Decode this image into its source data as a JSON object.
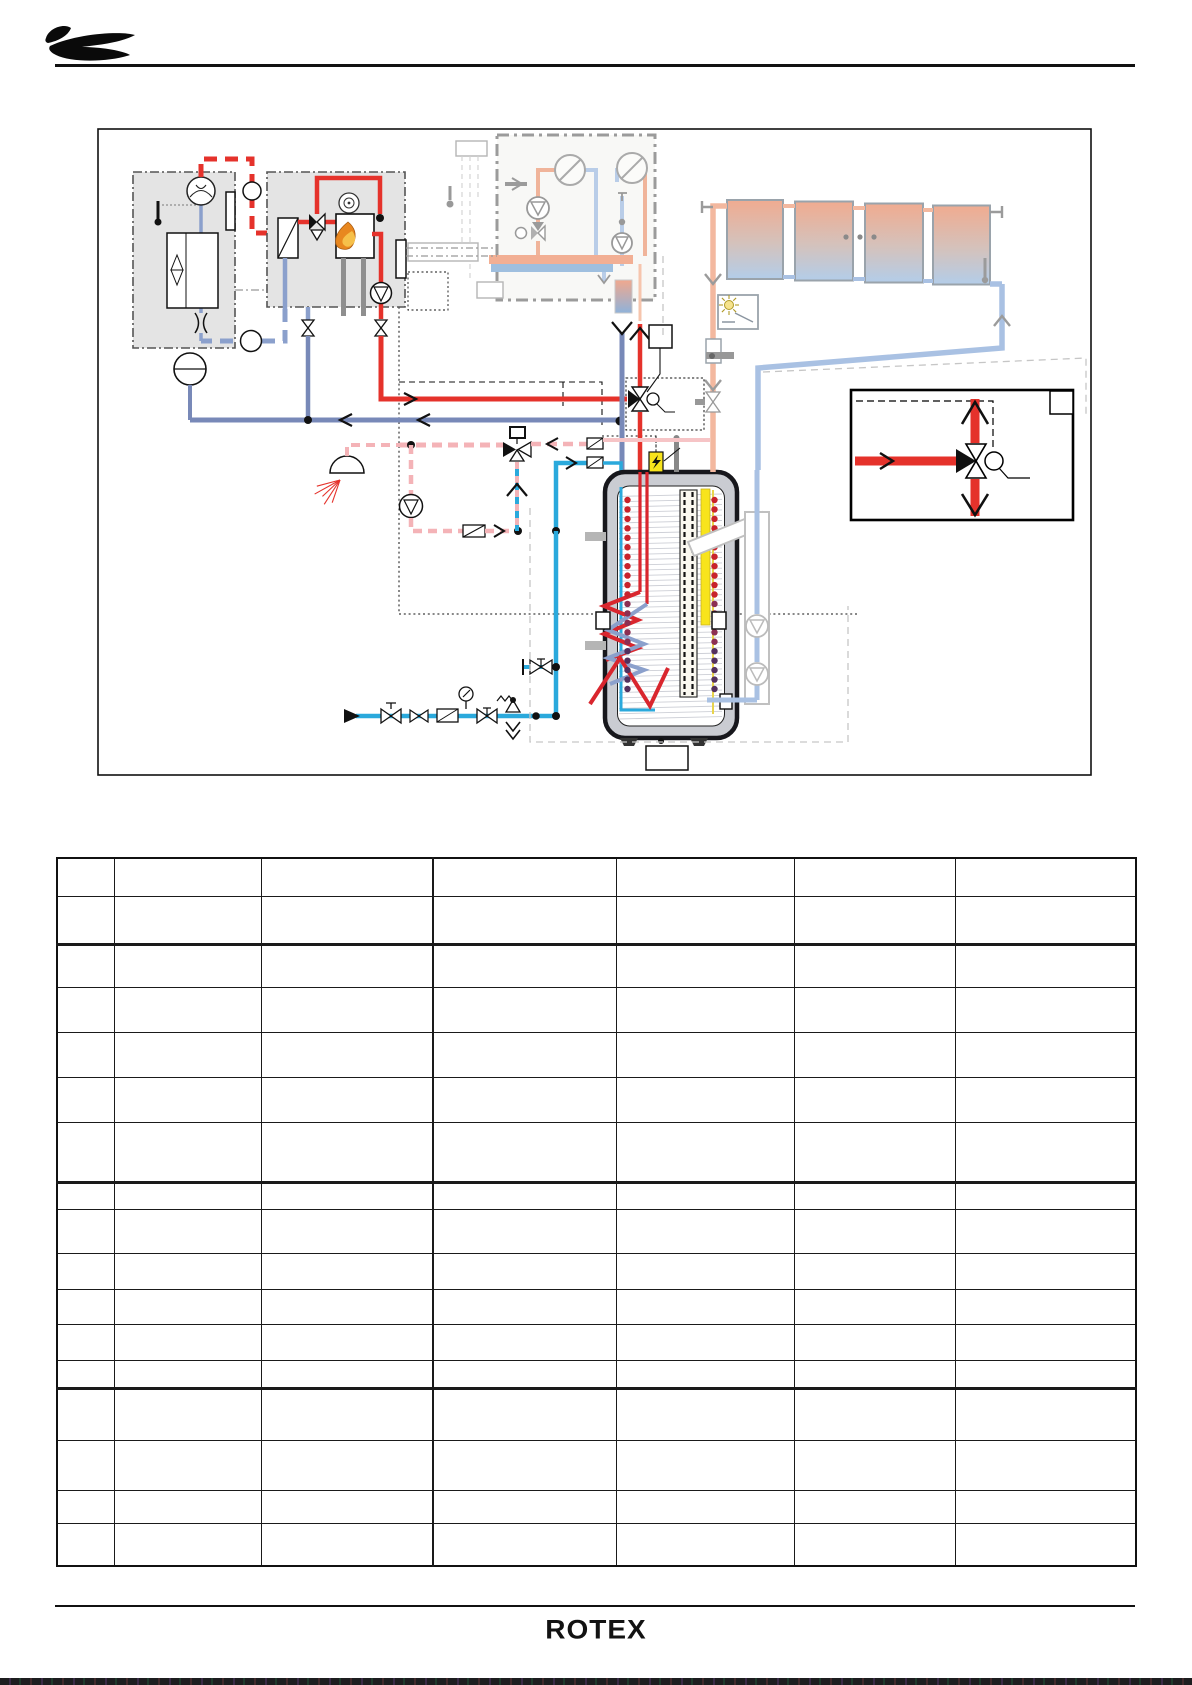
{
  "page": {
    "width": 1192,
    "height": 1685,
    "background": "#ffffff",
    "footer_logo_text": "ROTEX",
    "bottom_bar_color": "#1d1d1f"
  },
  "header": {
    "brand_mark": "manufacturer-swoosh-logo",
    "rule_color": "#111111"
  },
  "diagram": {
    "frame": {
      "x": 98,
      "y": 129,
      "w": 993,
      "h": 646,
      "stroke": "#111111"
    },
    "note": "hydraulic scheme: air-to-water heat pump + boiler + solar collector field charging a Sanicube storage tank; no visible text labels, all label boxes are empty",
    "components": [
      {
        "name": "heat-pump-outdoor-unit"
      },
      {
        "name": "refrigerant-lines"
      },
      {
        "name": "boiler-unit-with-burner"
      },
      {
        "name": "plate-heat-exchanger"
      },
      {
        "name": "heating-circuit-module-faded"
      },
      {
        "name": "expansion-vessel"
      },
      {
        "name": "dhw-mixing-circuit"
      },
      {
        "name": "shower-outlet"
      },
      {
        "name": "circulation-pump"
      },
      {
        "name": "cold-water-inlet-group"
      },
      {
        "name": "storage-tank-with-coils"
      },
      {
        "name": "electric-heater-rod"
      },
      {
        "name": "solar-collector-array"
      },
      {
        "name": "sun-sensor"
      },
      {
        "name": "solar-pump-station-faded"
      },
      {
        "name": "three-way-valve-detail-inset"
      },
      {
        "name": "empty-label-boxes"
      }
    ],
    "colors": {
      "heating_flow_red": "#e5322b",
      "heating_return_blue": "#7889b8",
      "refrigerant_blue": "#8ba0cc",
      "cold_water_cyan": "#2aa9dc",
      "dhw_warm_pink": "#f4b3b7",
      "solar_flow_salmon": "#f3b89f",
      "solar_return_blue": "#a9c1e3",
      "faded_gray": "#c0c0c0",
      "module_box_fill": "#e4e4e4",
      "tank_shell": "#caccd2",
      "heater_yellow": "#f8e41c",
      "flame_orange": "#e8871f"
    },
    "tank": {
      "dots": {
        "count": 21,
        "start_y": 500,
        "step": 9.45,
        "r": 3.2,
        "columns": [
          627.5,
          714.5
        ],
        "colors": {
          "top": "#c8232b",
          "mid": "#8c2f52",
          "bottom": "#53305e"
        },
        "top_n": 11,
        "mid_n": 16
      },
      "hatch": {
        "x1": 619,
        "x2": 722,
        "y0": 494,
        "y1": 718,
        "step": 5.3,
        "color": "#cdcfd6"
      }
    },
    "solar": {
      "sun": {
        "cx": 729,
        "cy": 305,
        "r1": 6,
        "r2": 10,
        "rays": 8,
        "color": "#b09a28"
      }
    },
    "shower": {
      "spray": {
        "x": 340,
        "y": 480,
        "count": 5,
        "color": "#e5322b"
      }
    }
  },
  "table": {
    "x": 56,
    "y": 857,
    "column_widths": [
      57,
      147,
      172,
      183,
      178,
      161,
      181
    ],
    "row_heights": [
      38,
      48,
      43,
      45,
      45,
      45,
      60,
      27,
      44,
      36,
      35,
      36,
      28,
      52,
      50,
      33,
      43
    ],
    "thick_after_rows": [
      2,
      7,
      13
    ],
    "thick_after_col": 3,
    "border_color": "#1a1a1a",
    "cells_text": ""
  }
}
